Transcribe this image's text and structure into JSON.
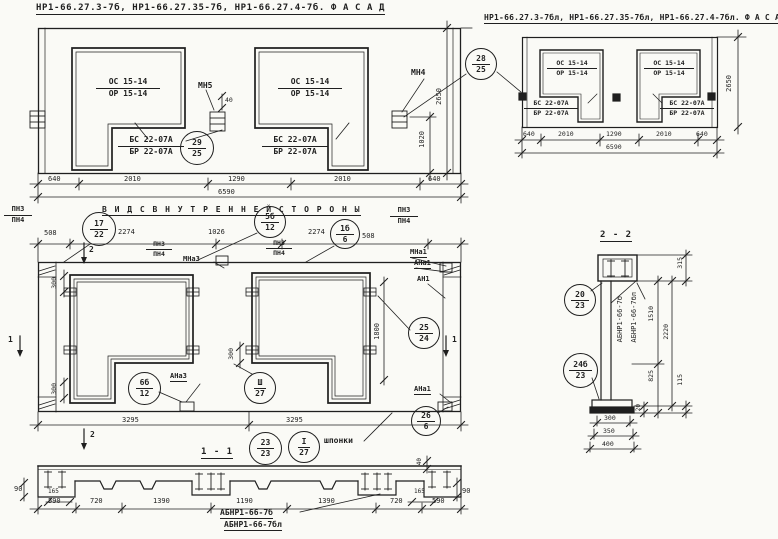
{
  "sheet": {
    "background": "#fafaf6",
    "ink": "#1f1f1f"
  },
  "facade_left": {
    "title": "НР1-66.27.3-7б, НР1-66.27.35-7б, НР1-66.27.4-7б.  Ф А С А Д",
    "window_opening": {
      "top": "ОС 15-14",
      "bottom": "ОР 15-14"
    },
    "sill_block": {
      "top": "БС 22-07А",
      "bottom": "БР 22-07А"
    },
    "marks": {
      "mn5": "МН5",
      "mn4": "МН4",
      "dim40": "40"
    },
    "callouts": {
      "c29": {
        "num": "29",
        "sheet": "25"
      },
      "c28": {
        "num": "28",
        "sheet": "25"
      }
    },
    "dims_bottom": [
      "640",
      "2010",
      "1290",
      "2010",
      "640"
    ],
    "dim_total": "6590",
    "dim_height": "2650",
    "dim_1020": "1020"
  },
  "facade_right": {
    "title": "НР1-66.27.3-7бл, НР1-66.27.35-7бл, НР1-66.27.4-7бл. Ф А С А Д",
    "window_opening": {
      "top": "ОС 15-14",
      "bottom": "ОР 15-14"
    },
    "sill_block": {
      "top": "БС 22-07А",
      "bottom": "БР 22-07А"
    },
    "dims_bottom": [
      "640",
      "2010",
      "1290",
      "2010",
      "640"
    ],
    "dim_total": "6590",
    "dim_height": "2650"
  },
  "inner_view": {
    "title": "В И Д  С  В Н У Т Р Е Н Н Е Й  С Т О Р О Н Ы",
    "dims_top": [
      "508",
      "2274",
      "1026",
      "2274",
      "508"
    ],
    "dims_bottom": [
      "3295",
      "3295"
    ],
    "dim_300": "300",
    "dim_1800": "1800",
    "labels": {
      "pn3": "ПН3",
      "pn4": "ПН4",
      "mna3": "МНа3",
      "mna1": "МНа1",
      "ana1": "АНа1",
      "an1": "АН1",
      "ana3": "АНа3",
      "keys": "шпонки"
    },
    "callouts": {
      "c17": {
        "num": "17",
        "sheet": "22"
      },
      "c5b": {
        "num": "5б",
        "sheet": "12"
      },
      "c1b": {
        "num": "1б",
        "sheet": "6"
      },
      "c25": {
        "num": "25",
        "sheet": "24"
      },
      "c26": {
        "num": "26",
        "sheet": "6"
      },
      "c6b": {
        "num": "6б",
        "sheet": "12"
      },
      "c3r": {
        "num": "Ш",
        "sheet": "27"
      },
      "c23": {
        "num": "23",
        "sheet": "23"
      },
      "c1r": {
        "num": "I",
        "sheet": "27"
      }
    },
    "section_marks": {
      "s1": "1",
      "s2": "2"
    }
  },
  "section_1_1": {
    "title": "1 - 1",
    "dims": [
      "590",
      "720",
      "1390",
      "1190",
      "1390",
      "720",
      "590"
    ],
    "dim_90": "90",
    "dim_165": "165",
    "dim_40": "40",
    "label_line1": "АБНР1-66-7б",
    "label_line2": "АБНР1-66-7бл"
  },
  "section_2_2": {
    "title": "2 - 2",
    "dim_315": "315",
    "dim_1510": "1510",
    "dim_2220": "2220",
    "dim_825": "825",
    "dim_115": "115",
    "dim_20": "20",
    "dims_bottom": [
      "300",
      "350",
      "400"
    ],
    "label_line1": "АБНР1-66-7б",
    "label_line2": "АБНР1-66-7бл",
    "callouts": {
      "c20": {
        "num": "20",
        "sheet": "23"
      },
      "c24b": {
        "num": "24б",
        "sheet": "23"
      }
    }
  }
}
